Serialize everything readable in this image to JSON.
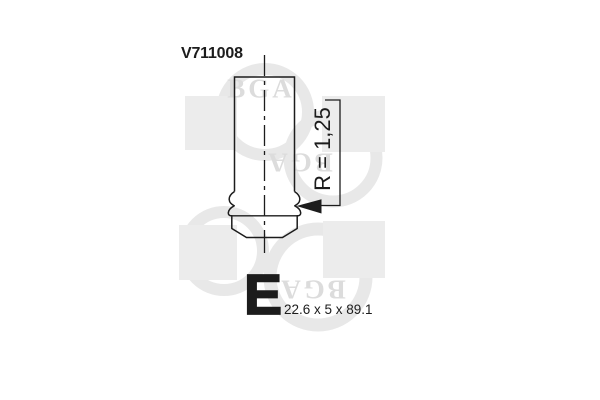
{
  "canvas": {
    "width": 600,
    "height": 400,
    "background": "#ffffff"
  },
  "drawing": {
    "part_number": "V711008",
    "radius_annotation": "R = 1,25",
    "valve_type_letter": "E",
    "dimensions_text": "22.6 x 5 x 89.1",
    "ink_color": "#1c1c1c"
  },
  "watermark": {
    "brand": "BGA",
    "square_color": "#ececec",
    "ring_color": "#e8e8e8",
    "letter_color": "#dcdcdc"
  }
}
